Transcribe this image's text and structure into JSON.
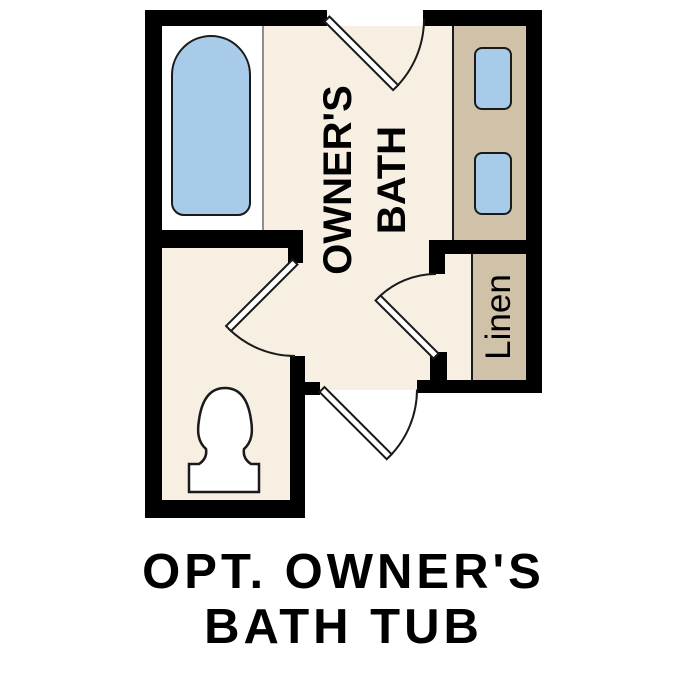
{
  "caption": {
    "line1": "OPT. OWNER'S",
    "line2": "BATH TUB"
  },
  "rooms": {
    "owners_bath": {
      "label_line1": "OWNER'S",
      "label_line2": "BATH"
    },
    "linen_closet": {
      "label": "Linen"
    }
  },
  "fixtures": [
    "bathtub",
    "toilet",
    "vanity-sink",
    "vanity-sink"
  ],
  "doors": [
    "bath-entry-door-top",
    "water-closet-door",
    "linen-closet-door",
    "hall-entry-door-bottom"
  ],
  "colors": {
    "floor": "#f6efe2",
    "cabinet": "#cfc2a9",
    "fixture": "#a9cbea",
    "wall": "#000000",
    "outline": "#1a1a1a",
    "divider": "#8f8f8f"
  }
}
